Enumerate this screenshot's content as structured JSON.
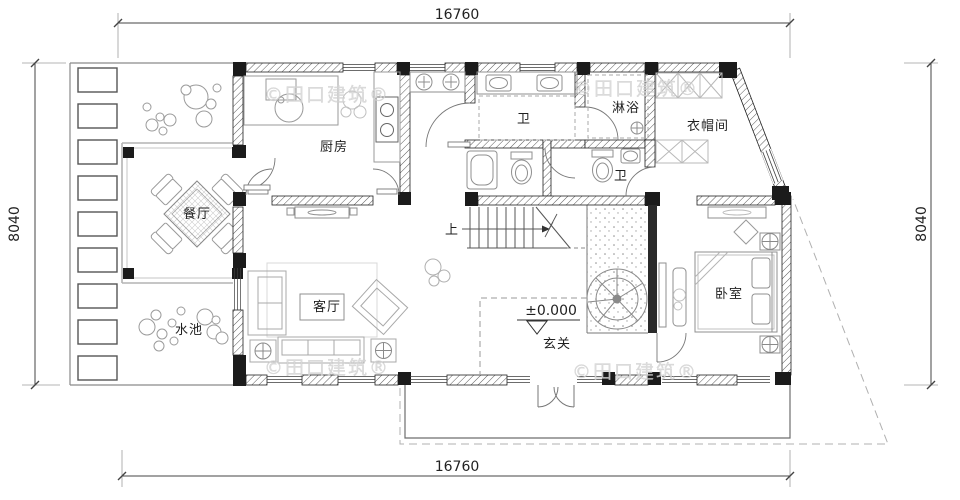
{
  "plan": {
    "rooms": [
      {
        "id": "kitchen",
        "label": "厨房"
      },
      {
        "id": "bath-main",
        "label": "卫"
      },
      {
        "id": "shower",
        "label": "淋浴"
      },
      {
        "id": "cloakroom",
        "label": "衣帽间"
      },
      {
        "id": "bath-second",
        "label": "卫"
      },
      {
        "id": "dining",
        "label": "餐厅"
      },
      {
        "id": "pool",
        "label": "水池"
      },
      {
        "id": "living",
        "label": "客厅"
      },
      {
        "id": "bedroom",
        "label": "卧室"
      },
      {
        "id": "foyer",
        "label": "玄关"
      }
    ],
    "stairs": {
      "up_label": "上"
    },
    "elevation": {
      "value": "±0.000"
    },
    "dimensions": {
      "top": "16760",
      "bottom": "16760",
      "left": "8040",
      "right": "8040"
    },
    "watermark": {
      "text": "©田口建筑®"
    }
  }
}
